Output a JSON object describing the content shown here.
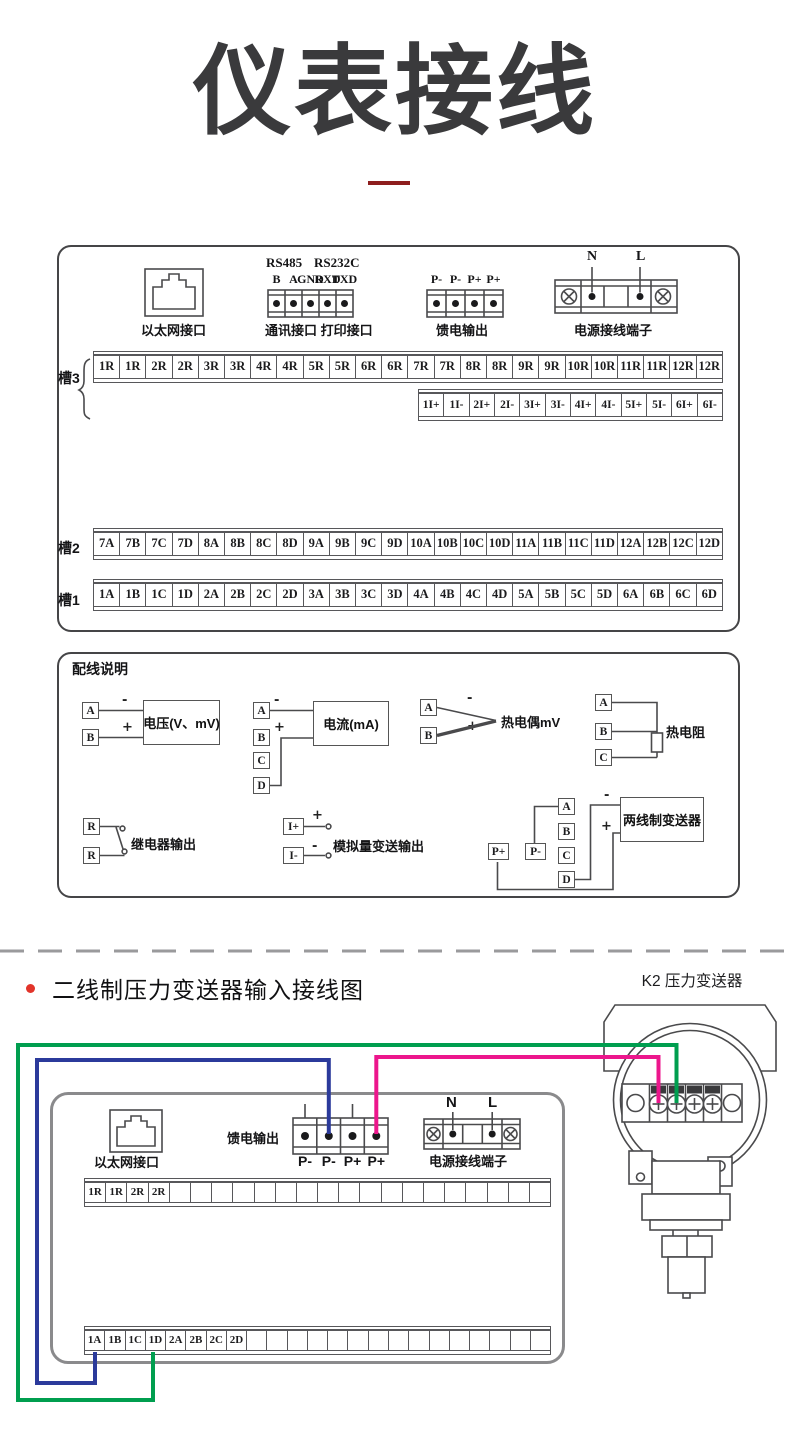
{
  "title": {
    "text": "仪表接线"
  },
  "panel1": {
    "ethernet_caption": "以太网接口",
    "comm": {
      "headers": [
        "RS485",
        "RS232C"
      ],
      "pins": [
        "B",
        "A",
        "GND",
        "RXD",
        "TXD"
      ],
      "caption": "通讯接口  打印接口"
    },
    "feed": {
      "pins": [
        "P-",
        "P-",
        "P+",
        "P+"
      ],
      "caption": "馈电输出"
    },
    "power": {
      "pins": [
        "N",
        "L"
      ],
      "caption": "电源接线端子"
    },
    "slot3": {
      "label": "槽3",
      "row1": [
        "1R",
        "1R",
        "2R",
        "2R",
        "3R",
        "3R",
        "4R",
        "4R",
        "5R",
        "5R",
        "6R",
        "6R",
        "7R",
        "7R",
        "8R",
        "8R",
        "9R",
        "9R",
        "10R",
        "10R",
        "11R",
        "11R",
        "12R",
        "12R"
      ],
      "row2": [
        "1I+",
        "1I-",
        "2I+",
        "2I-",
        "3I+",
        "3I-",
        "4I+",
        "4I-",
        "5I+",
        "5I-",
        "6I+",
        "6I-"
      ]
    },
    "slot2": {
      "label": "槽2",
      "row": [
        "7A",
        "7B",
        "7C",
        "7D",
        "8A",
        "8B",
        "8C",
        "8D",
        "9A",
        "9B",
        "9C",
        "9D",
        "10A",
        "10B",
        "10C",
        "10D",
        "11A",
        "11B",
        "11C",
        "11D",
        "12A",
        "12B",
        "12C",
        "12D"
      ]
    },
    "slot1": {
      "label": "槽1",
      "row": [
        "1A",
        "1B",
        "1C",
        "1D",
        "2A",
        "2B",
        "2C",
        "2D",
        "3A",
        "3B",
        "3C",
        "3D",
        "4A",
        "4B",
        "4C",
        "4D",
        "5A",
        "5B",
        "5C",
        "5D",
        "6A",
        "6B",
        "6C",
        "6D"
      ]
    }
  },
  "panel2": {
    "title": "配线说明",
    "voltage": {
      "terminals": [
        "A",
        "B"
      ],
      "signs": [
        "-",
        "+"
      ],
      "device": "电压(V、mV)"
    },
    "current": {
      "terminals": [
        "A",
        "B",
        "C",
        "D"
      ],
      "signs": [
        "-",
        "+"
      ],
      "device": "电流(mA)"
    },
    "thermocouple": {
      "terminals": [
        "A",
        "B"
      ],
      "signs": [
        "-",
        "+"
      ],
      "device": "热电偶mV"
    },
    "rtd": {
      "terminals": [
        "A",
        "B",
        "C"
      ],
      "device": "热电阻"
    },
    "relay": {
      "terminals": [
        "R",
        "R"
      ],
      "device": "继电器输出"
    },
    "analog_out": {
      "terminals": [
        "I+",
        "I-"
      ],
      "signs": [
        "+",
        "-"
      ],
      "device": "模拟量变送输出"
    },
    "two_wire": {
      "feed_terminals": [
        "P+",
        "P-"
      ],
      "terminals": [
        "A",
        "B",
        "C",
        "D"
      ],
      "signs": [
        "-",
        "+"
      ],
      "device": "两线制变送器"
    }
  },
  "section2": {
    "heading": "二线制压力变送器输入接线图",
    "device_label": "K2  压力变送器"
  },
  "panel3": {
    "ethernet_caption": "以太网接口",
    "feed": {
      "caption": "馈电输出",
      "pins": [
        "P-",
        "P-",
        "P+",
        "P+"
      ]
    },
    "power": {
      "pins": [
        "N",
        "L"
      ],
      "caption": "电源接线端子"
    },
    "row_top": [
      "1R",
      "1R",
      "2R",
      "2R",
      "",
      "",
      "",
      "",
      "",
      "",
      "",
      "",
      "",
      "",
      "",
      "",
      "",
      "",
      "",
      "",
      "",
      ""
    ],
    "row_bottom": [
      "1A",
      "1B",
      "1C",
      "1D",
      "2A",
      "2B",
      "2C",
      "2D",
      "",
      "",
      "",
      "",
      "",
      "",
      "",
      "",
      "",
      "",
      "",
      "",
      "",
      "",
      ""
    ],
    "transmitter": {
      "signs": [
        "+",
        "-",
        "+",
        "-"
      ],
      "letters": [
        "A",
        "B",
        "└A┘"
      ]
    }
  },
  "colors": {
    "wire_green": "#009e4f",
    "wire_blue": "#2b3a9b",
    "wire_pink": "#ec168c",
    "bullet_red": "#e2342a",
    "underline_red": "#8e1e1e",
    "line_gray": "#4a4a4c"
  }
}
